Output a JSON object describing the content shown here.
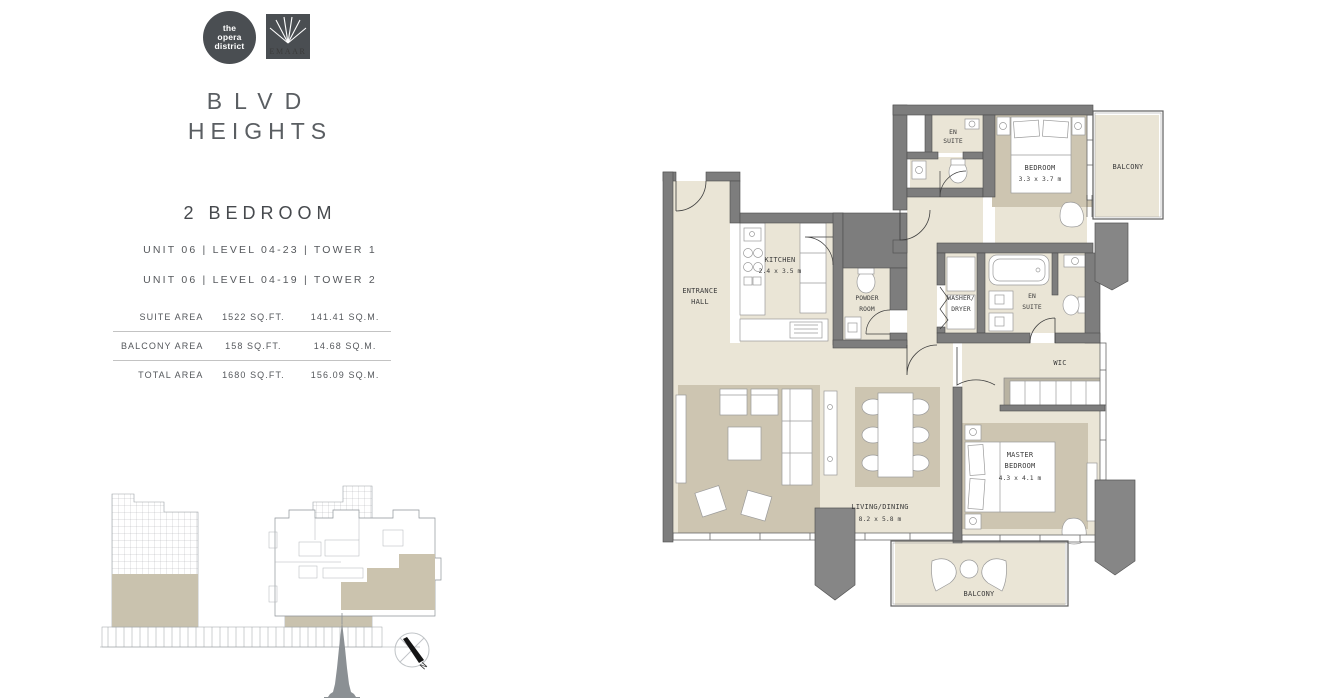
{
  "brand": {
    "opera_logo": {
      "l1": "the",
      "l2": "opera",
      "l3": "district"
    },
    "emaar": "EMAAR",
    "title_l1": "BLVD",
    "title_l2": "HEIGHTS"
  },
  "unit": {
    "type": "2 BEDROOM",
    "variant1": "UNIT 06  |  LEVEL 04-23   |  TOWER 1",
    "variant2": "UNIT 06  |  LEVEL 04-19   |  TOWER 2",
    "areas": [
      {
        "label": "SUITE AREA",
        "sqft": "1522 SQ.FT.",
        "sqm": "141.41 SQ.M."
      },
      {
        "label": "BALCONY AREA",
        "sqft": "158 SQ.FT.",
        "sqm": "14.68 SQ.M."
      },
      {
        "label": "TOTAL AREA",
        "sqft": "1680 SQ.FT.",
        "sqm": "156.09 SQ.M."
      }
    ]
  },
  "plan": {
    "rooms": {
      "en_suite_top": {
        "l1": "EN",
        "l2": "SUITE"
      },
      "bedroom": {
        "name": "BEDROOM",
        "dim": "3.3 x 3.7 m"
      },
      "balcony_top": "BALCONY",
      "entrance": {
        "l1": "ENTRANCE",
        "l2": "HALL"
      },
      "kitchen": {
        "name": "KITCHEN",
        "dim": "2.4 x 3.5 m"
      },
      "powder": {
        "l1": "POWDER",
        "l2": "ROOM"
      },
      "washer": {
        "l1": "WASHER/",
        "l2": "DRYER"
      },
      "en_suite_mid": {
        "l1": "EN",
        "l2": "SUITE"
      },
      "wic": "WIC",
      "living": {
        "name": "LIVING/DINING",
        "dim": "8.2 x 5.8 m"
      },
      "master": {
        "l1": "MASTER",
        "l2": "BEDROOM",
        "dim": "4.3 x 4.1 m"
      },
      "balcony_bottom": "BALCONY"
    },
    "compass": {
      "north": "N"
    }
  },
  "colors": {
    "wall_gray": "#7d7d7d",
    "floor_beige": "#eae5d6",
    "rug_beige": "#cdc5b1",
    "logo_gray": "#4a4e52",
    "text_gray": "#55585c"
  }
}
